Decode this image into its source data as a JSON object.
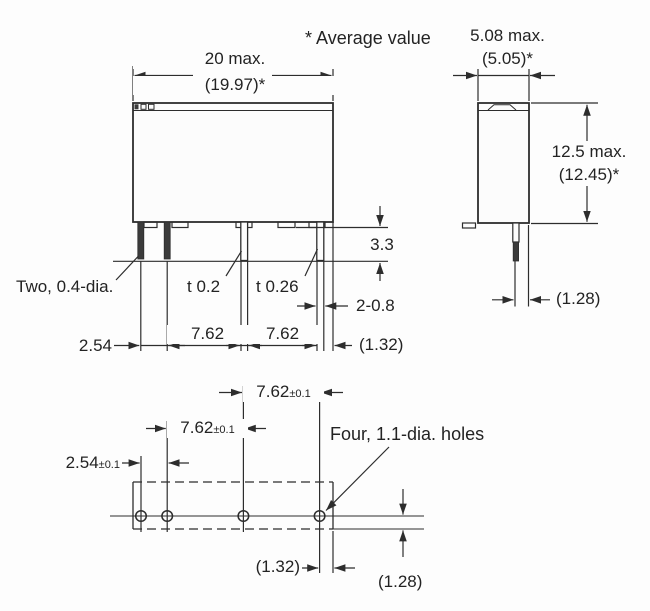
{
  "note": "* Average value",
  "front_view": {
    "width": "20 max.",
    "width_avg": "(19.97)*",
    "pin_length": "3.3",
    "pin_label_left": "Two, 0.4-dia.",
    "pin_label_mid": "t 0.2",
    "pin_label_right": "t 0.26",
    "pin_width": "2-0.8",
    "pitch_left": "2.54",
    "pitch_mid": "7.62",
    "pitch_right": "7.62",
    "edge_offset": "(1.32)"
  },
  "side_view": {
    "width": "5.08 max.",
    "width_avg": "(5.05)*",
    "height": "12.5 max.",
    "height_avg": "(12.45)*",
    "pin_offset": "(1.28)"
  },
  "pcb_layout": {
    "holes_label": "Four, 1.1-dia. holes",
    "pitch1_value": "7.62",
    "pitch1_tol": "±0.1",
    "pitch2_value": "7.62",
    "pitch2_tol": "±0.1",
    "pitch3_value": "2.54",
    "pitch3_tol": "±0.1",
    "edge_offset_x": "(1.32)",
    "edge_offset_y": "(1.28)"
  }
}
